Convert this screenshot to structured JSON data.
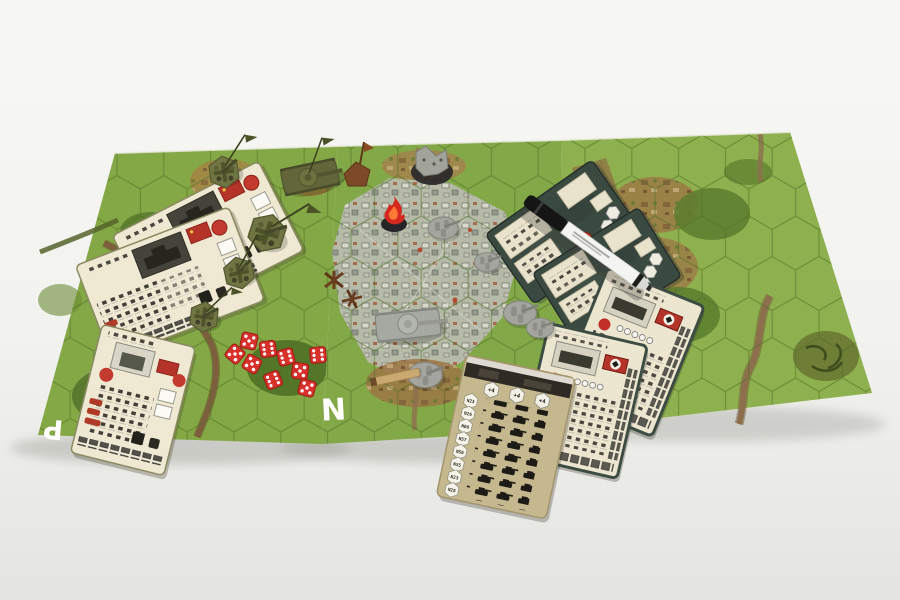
{
  "scene": {
    "type": "tabletop wargame photograph",
    "background_color": "#f2f2ef",
    "description": "Three hex map boards on a white table with WWII miniatures, unit cards, red dice and a dry-erase marker"
  },
  "boards": {
    "left": {
      "letter": "P",
      "base_color": "#84a845"
    },
    "middle": {
      "letter": "N",
      "base_color": "#83a847"
    },
    "right": {
      "base_color": "#8eb04e"
    }
  },
  "cards": {
    "soviet": {
      "count": 3,
      "face_color": "#efe9d4",
      "flag_color": "#b5342a"
    },
    "german_command": {
      "count": 2,
      "back_color": "#3b4a41"
    },
    "german_units": {
      "count": 2,
      "face_color": "#ece5d0",
      "border_color": "#3d4c42"
    },
    "reinforcement": {
      "face_color": "#c6b88e",
      "top_badges": [
        "+4",
        "+4",
        "+4"
      ],
      "hex_labels": [
        "N23",
        "N26",
        "N06",
        "N57",
        "N56",
        "N55",
        "N23",
        "N28"
      ],
      "tank_rows": 8,
      "tank_columns": 3
    }
  },
  "pieces": {
    "soviet_tank": {
      "count": 1,
      "color": "#62663a"
    },
    "soviet_gun_crews": {
      "count": 4,
      "color": "#707544"
    },
    "german_tank": {
      "count": 1,
      "color": "#a6a8a2"
    },
    "german_infantry_groups": {
      "count": 5,
      "color": "#a3a59e"
    },
    "flame_marker": {
      "count": 1,
      "color": "#d5281e"
    },
    "ruined_building": {
      "count": 1,
      "color": "#a2a49c"
    },
    "wooden_flag_marker": {
      "count": 1,
      "color": "#7c4a26"
    },
    "tank_traps": {
      "count": 2,
      "color": "#6b3d20"
    }
  },
  "dice": {
    "count": 9,
    "color": "#d8302a",
    "pip_color": "#ffffff"
  },
  "marker_pen": {
    "cap_color": "#1a1a1a",
    "barrel_color": "#f4f4f2"
  },
  "icons": {
    "soviet-flag-icon": "red rectangle flag",
    "german-flag-icon": "red flag with white disc and black cross",
    "red-star-icon": "red disc badge",
    "tank-silhouette-icon": "black tank glyph grid",
    "hex-badge-icon": "white hexagon badge",
    "flame-icon": "red flame on black base"
  }
}
